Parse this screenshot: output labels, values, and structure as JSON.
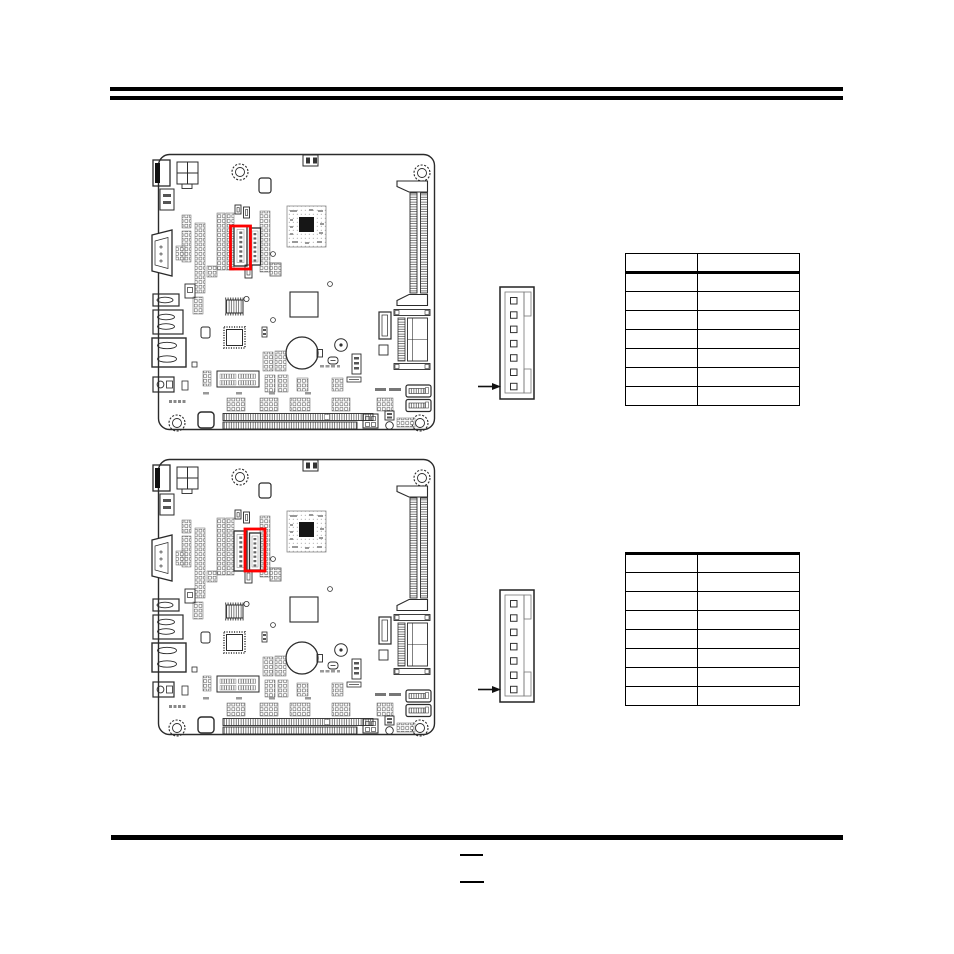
{
  "document": {
    "kind": "motherboard-manual-page",
    "background": "#ffffff",
    "rule_color": "#000000",
    "highlight_color": "#ff0000",
    "line_color": "#2b2b2b"
  },
  "figures": {
    "board_top": {
      "caption": "",
      "highlighted_connector": "left-vertical-connector"
    },
    "board_bottom": {
      "caption": "",
      "highlighted_connector": "right-vertical-connector"
    },
    "pin_header_top": {
      "caption": "",
      "pin_count": 7,
      "arrow_points_to": "pin-1-bottom"
    },
    "pin_header_bottom": {
      "caption": "",
      "pin_count": 7,
      "arrow_points_to": "pin-1-bottom"
    }
  },
  "tables": {
    "top": {
      "columns": [
        "",
        ""
      ],
      "rows": [
        [
          "",
          ""
        ],
        [
          "",
          ""
        ],
        [
          "",
          ""
        ],
        [
          "",
          ""
        ],
        [
          "",
          ""
        ],
        [
          "",
          ""
        ],
        [
          "",
          ""
        ]
      ]
    },
    "bottom": {
      "columns": [
        "",
        ""
      ],
      "rows": [
        [
          "",
          ""
        ],
        [
          "",
          ""
        ],
        [
          "",
          ""
        ],
        [
          "",
          ""
        ],
        [
          "",
          ""
        ],
        [
          "",
          ""
        ],
        [
          "",
          ""
        ]
      ]
    }
  },
  "footer": {
    "page_line_top": "",
    "page_line_bottom": ""
  }
}
